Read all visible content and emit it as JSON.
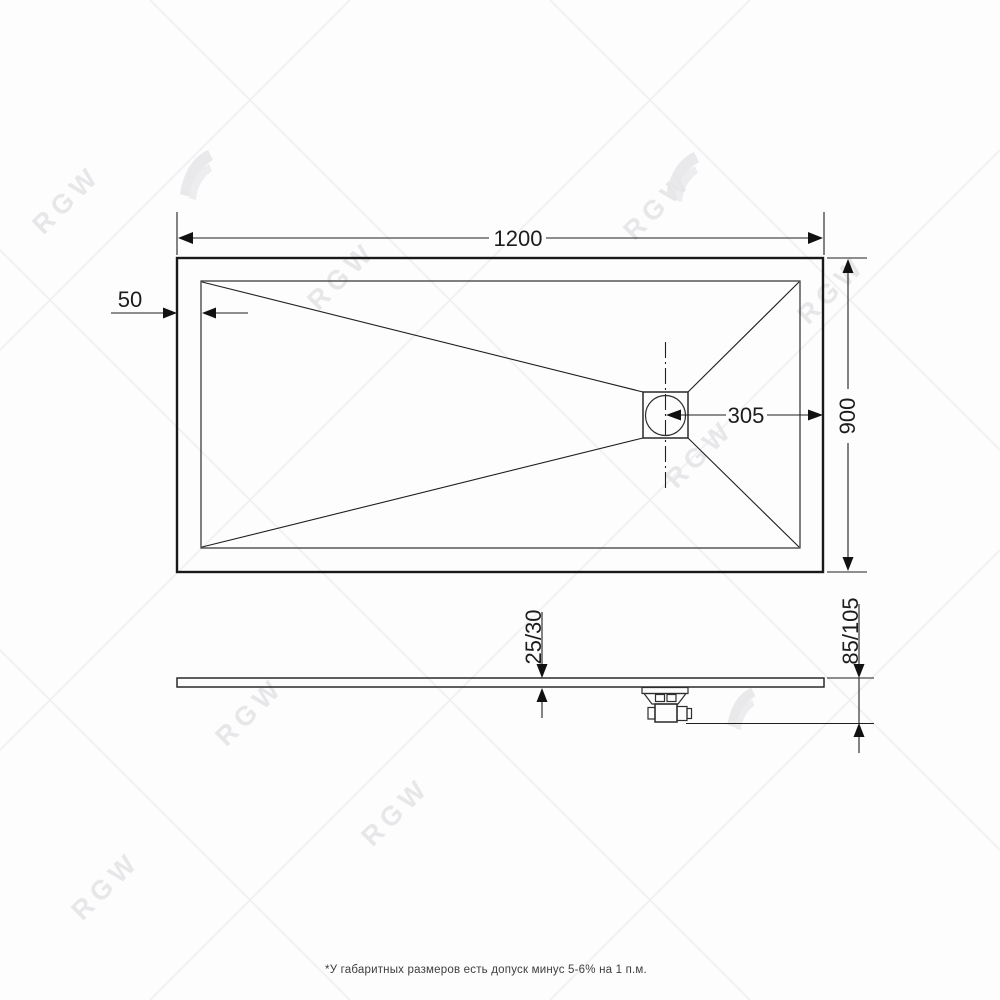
{
  "top_view": {
    "width_label": "1200",
    "edge_offset_label": "50",
    "drain_offset_label": "305",
    "depth_label": "900"
  },
  "side_view": {
    "thickness_label": "25/30",
    "height_label": "85/105"
  },
  "footer": {
    "note": "*У габаритных размеров есть допуск минус 5-6% на 1 п.м."
  },
  "watermark": {
    "brand": "RGW"
  }
}
